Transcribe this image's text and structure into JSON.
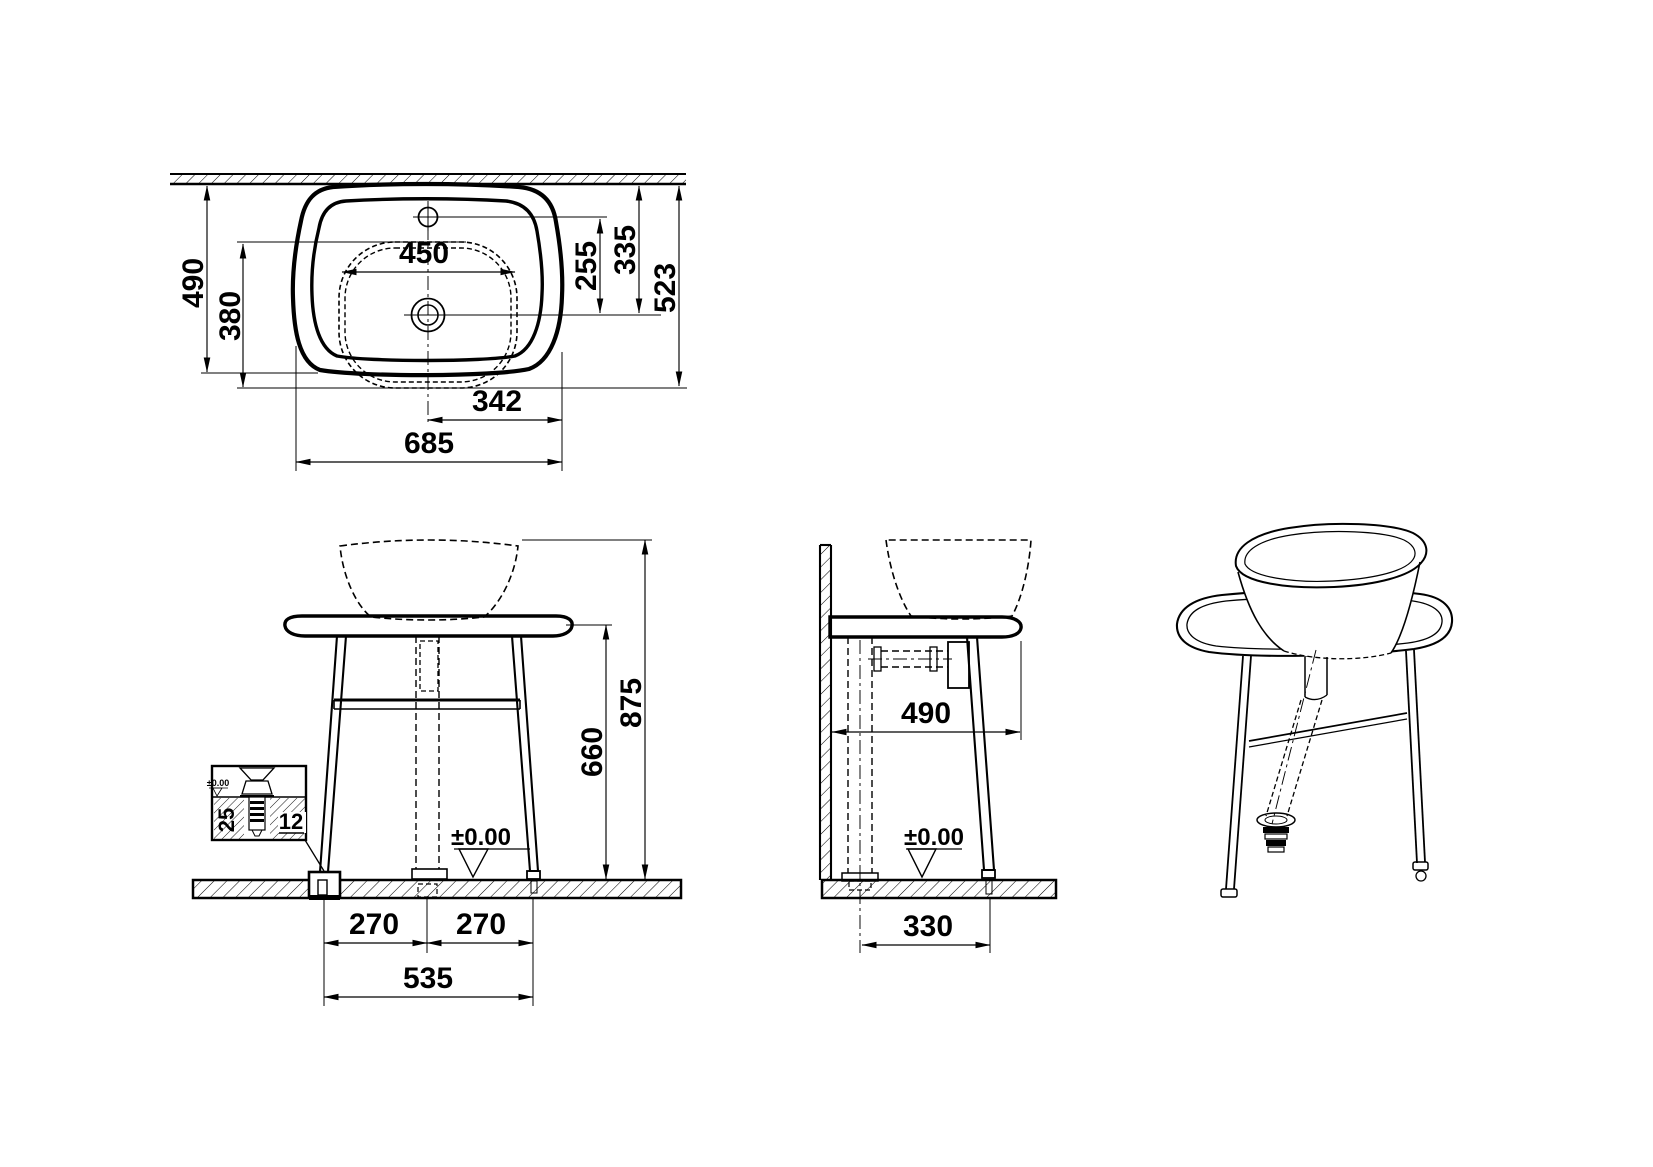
{
  "views": {
    "plan": {
      "dims": {
        "wall_to_basin_front": "490",
        "tray_depth": "380",
        "tray_width": "450",
        "faucet_to_drain": "255",
        "wall_to_drain": "335",
        "wall_to_front_edge": "523",
        "center_to_edge": "342",
        "overall_width": "685"
      }
    },
    "front": {
      "dims": {
        "overall_height": "875",
        "stand_height": "660",
        "leg_offset_left": "270",
        "leg_offset_right": "270",
        "leg_span": "535",
        "floor_level": "±0.00"
      },
      "anchor_detail": {
        "embed_depth": "25",
        "bolt_size": "12",
        "floor_level": "±0.00"
      }
    },
    "side": {
      "dims": {
        "depth": "490",
        "drain_to_leg": "330",
        "floor_level": "±0.00"
      }
    }
  }
}
